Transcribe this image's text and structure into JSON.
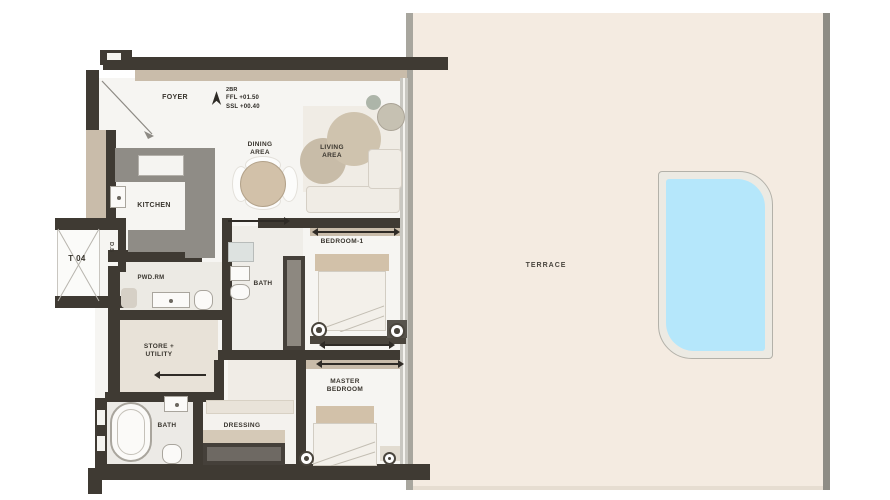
{
  "unit": {
    "tag": "T 04",
    "type": "2BR",
    "ffl": "FFL +01.50",
    "ssl": "SSL +00.40"
  },
  "rooms": {
    "foyer": "FOYER",
    "kitchen": "KITCHEN",
    "dining": "DINING\nAREA",
    "living": "LIVING\nAREA",
    "db": "D.B",
    "powder": "PWD.RM",
    "store": "STORE +\nUTILITY",
    "bath1": "BATH",
    "bedroom1": "BEDROOM-1",
    "master_bath": "BATH",
    "dressing": "DRESSING",
    "master_bedroom": "MASTER\nBEDROOM",
    "terrace": "TERRACE"
  },
  "icons": {
    "north_arrow": "north-arrow-icon",
    "entry_door_swing": "door-swing-icon",
    "lift_cross": "lift-shaft-cross-icon",
    "window_span_arrow": "window-span-arrow-icon",
    "door_direction_arrow": "door-direction-arrow-icon"
  },
  "colors": {
    "wall": "#3f3a33",
    "wall_accent": "#c9bcaa",
    "floor": "#f6f5f2",
    "floor_soft": "#eceae4",
    "floor_warm": "#e8e2d8",
    "counter": "#8f8c86",
    "furniture": "#d2c1a9",
    "terrace": "#f4ebe1",
    "terrace_border": "#a8a69e",
    "pool": "#b5e7fb",
    "pool_deck": "#eceae3",
    "text": "#39352e"
  }
}
